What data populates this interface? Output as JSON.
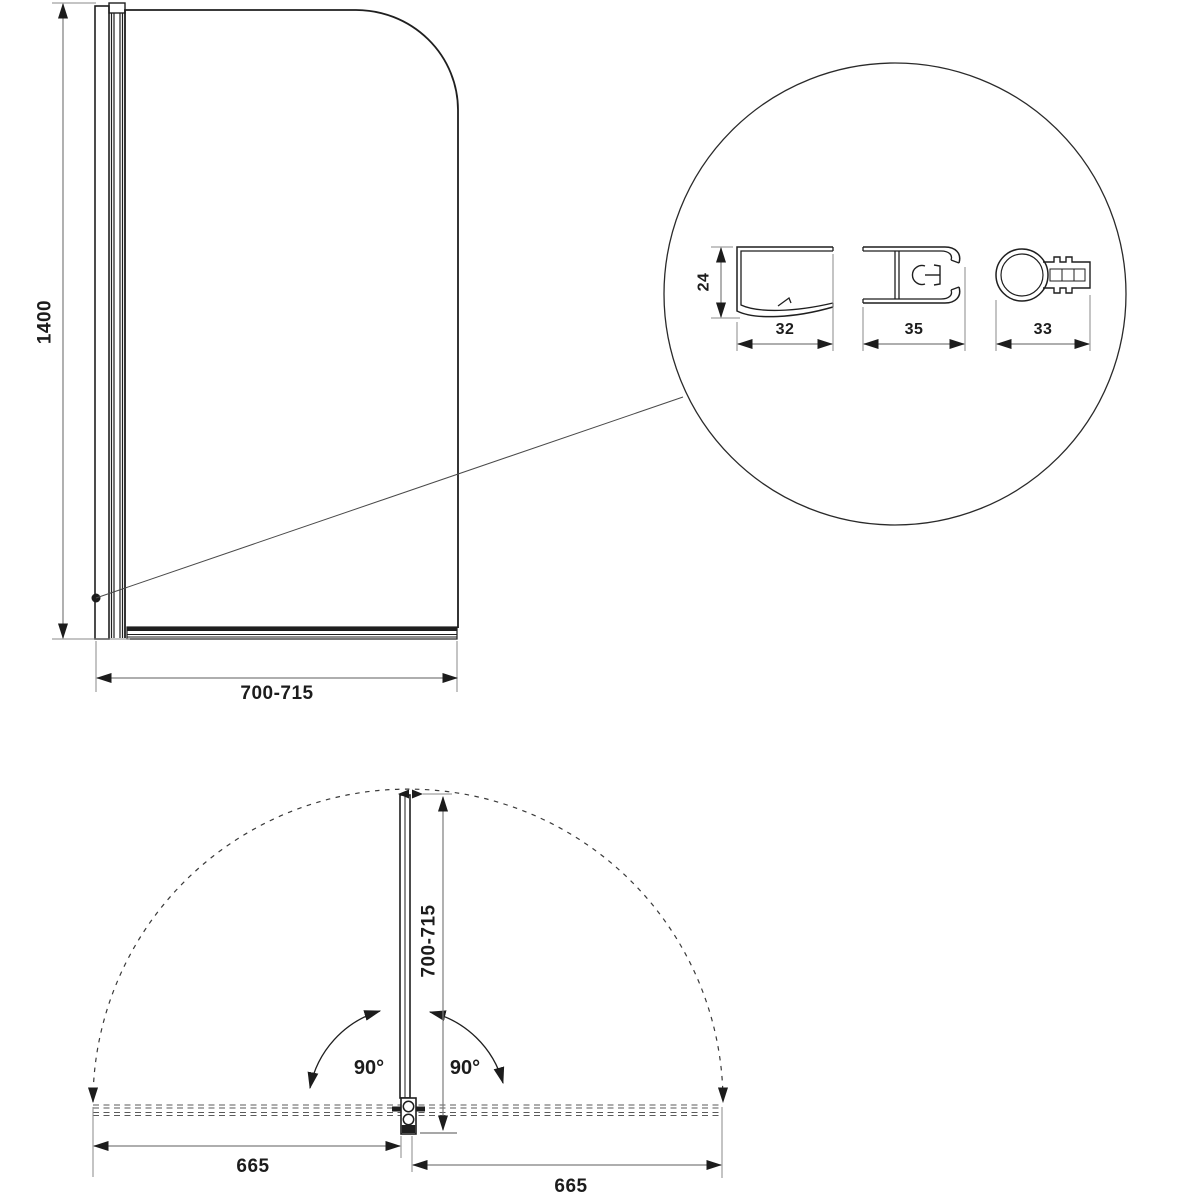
{
  "drawing": {
    "title": "bath-screen-technical-drawing",
    "front_view": {
      "height_dim": "1400",
      "width_dim": "700-715"
    },
    "detail_circle": {
      "wall_profile": {
        "height_dim": "24",
        "width_dim": "32"
      },
      "pivot_profile": {
        "width_dim": "35"
      },
      "handle_profile": {
        "width_dim": "33"
      }
    },
    "plan_view": {
      "depth_dim": "700-715",
      "swing_angle_left": "90°",
      "swing_angle_right": "90°",
      "left_span_dim": "665",
      "right_span_dim": "665"
    },
    "colors": {
      "line": "#1f1f1f",
      "dim_line": "#7d7d7d",
      "background": "#ffffff"
    }
  }
}
